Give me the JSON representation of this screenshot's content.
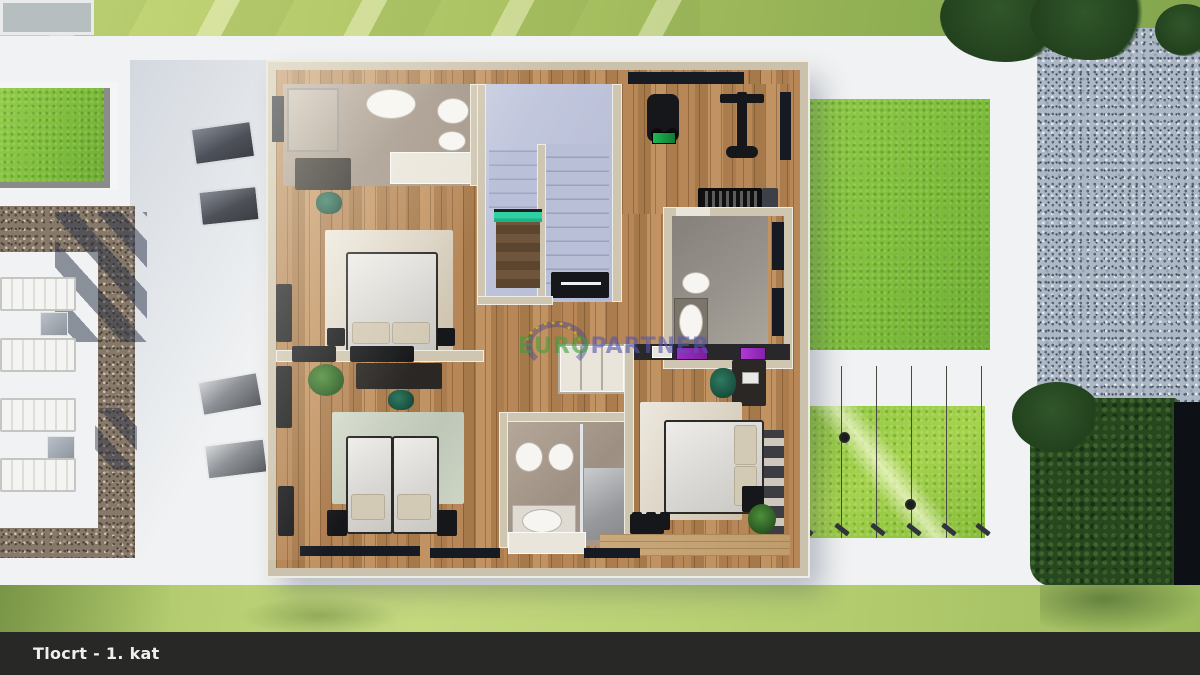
{
  "title_bar": {
    "text": "Tlocrt - 1. kat"
  },
  "watermark": {
    "text_green": "EURO",
    "text_purple": "PARTNER",
    "star": "★",
    "green_color": "#3f9f3c",
    "purple_color": "#5756b0",
    "stars_color": "#c9a930",
    "arc_color": "#484694"
  },
  "colors": {
    "title_bar_bg": "#282826",
    "title_text": "#f0efed",
    "terrace_white": "#f0f2f3",
    "lawn_top": "#a9c161",
    "lawn_bright": "#7dbc3a",
    "lawn_bottom": "#b3cc6e",
    "tree_dark_green": "#27471f",
    "gravel_brown": "#877969",
    "gravel_blue": "#adb8c6",
    "wood_floor": "#b78757",
    "deck_wood": "#c9a87a",
    "bathroom_tile_taupe": "#a59787",
    "bathroom_tile_gray": "#8f8a83",
    "stairs_blue": "#b9bfd7",
    "wall_beige": "#cfc6b2",
    "accent_purple": "#a12cc4",
    "accent_teal": "#2fd0a2",
    "chair_green": "#1e5c48",
    "window_dark": "#161a22"
  }
}
